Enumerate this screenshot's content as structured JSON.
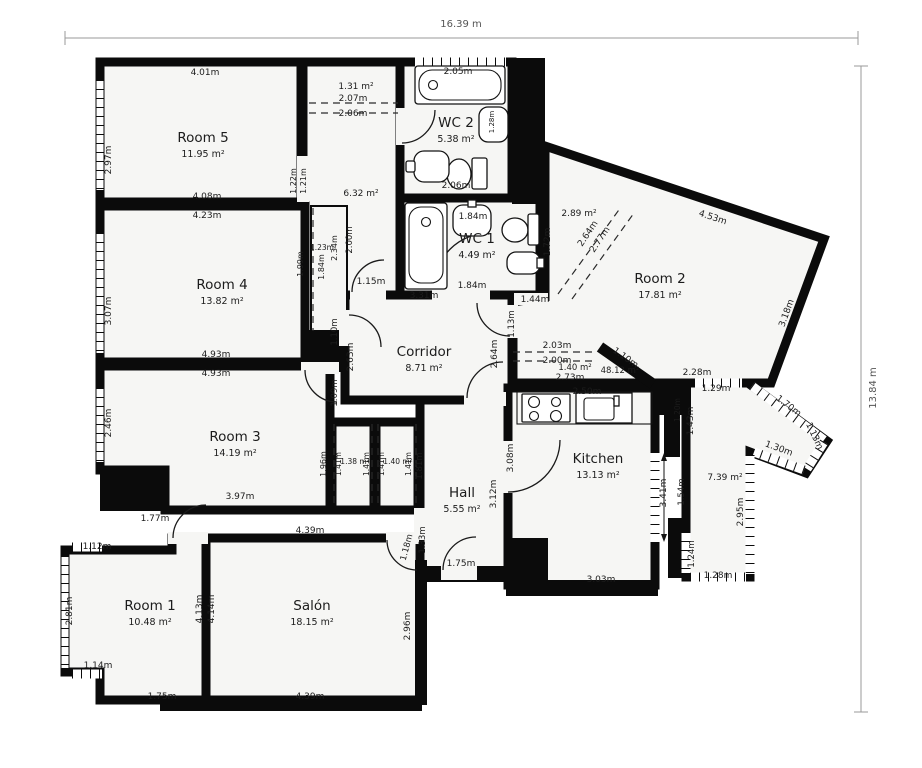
{
  "meta": {
    "plan_width_label": "16.39 m",
    "plan_height_label": "13.84 m"
  },
  "rooms": [
    {
      "id": "room5",
      "name": "Room 5",
      "area": "11.95 m²",
      "x": 203,
      "y": 142
    },
    {
      "id": "room4",
      "name": "Room 4",
      "area": "13.82 m²",
      "x": 222,
      "y": 289
    },
    {
      "id": "room3",
      "name": "Room 3",
      "area": "14.19 m²",
      "x": 235,
      "y": 441
    },
    {
      "id": "room2",
      "name": "Room 2",
      "area": "17.81 m²",
      "x": 660,
      "y": 283
    },
    {
      "id": "room1",
      "name": "Room 1",
      "area": "10.48 m²",
      "x": 150,
      "y": 610
    },
    {
      "id": "salon",
      "name": "Salón",
      "area": "18.15 m²",
      "x": 312,
      "y": 610
    },
    {
      "id": "kitchen",
      "name": "Kitchen",
      "area": "13.13 m²",
      "x": 598,
      "y": 463
    },
    {
      "id": "hall",
      "name": "Hall",
      "area": "5.55 m²",
      "x": 462,
      "y": 497
    },
    {
      "id": "corridor",
      "name": "Corridor",
      "area": "8.71 m²",
      "x": 424,
      "y": 356
    },
    {
      "id": "wc1",
      "name": "WC 1",
      "area": "4.49 m²",
      "x": 477,
      "y": 243
    },
    {
      "id": "wc2",
      "name": "WC 2",
      "area": "5.38 m²",
      "x": 456,
      "y": 127
    }
  ],
  "dims": [
    {
      "t": "4.01m",
      "x": 205,
      "y": 75
    },
    {
      "t": "2.97m",
      "x": 111,
      "y": 160,
      "r": -90
    },
    {
      "t": "4.08m",
      "x": 207,
      "y": 199
    },
    {
      "t": "4.23m",
      "x": 207,
      "y": 218
    },
    {
      "t": "1.31 m²",
      "x": 356,
      "y": 89
    },
    {
      "t": "2.07m",
      "x": 353,
      "y": 101
    },
    {
      "t": "2.06m",
      "x": 353,
      "y": 116
    },
    {
      "t": "2.05m",
      "x": 458,
      "y": 74
    },
    {
      "t": "2.06m",
      "x": 456,
      "y": 188
    },
    {
      "t": "1.28m",
      "x": 494,
      "y": 122,
      "r": -90,
      "s": 7
    },
    {
      "t": "1.22m",
      "x": 296,
      "y": 181,
      "r": -90,
      "s": 8
    },
    {
      "t": "1.21m",
      "x": 306,
      "y": 181,
      "r": -90,
      "s": 8
    },
    {
      "t": "6.32 m²",
      "x": 361,
      "y": 196
    },
    {
      "t": "1.99m",
      "x": 303,
      "y": 264,
      "r": -90,
      "s": 8
    },
    {
      "t": "1.23m",
      "x": 322,
      "y": 250,
      "s": 7.5
    },
    {
      "t": "1.84m",
      "x": 324,
      "y": 267,
      "r": -90,
      "s": 8
    },
    {
      "t": "2.34m",
      "x": 337,
      "y": 248,
      "r": -90,
      "s": 8
    },
    {
      "t": "2.00m",
      "x": 352,
      "y": 240,
      "r": -90,
      "s": 8.5
    },
    {
      "t": "1.15m",
      "x": 371,
      "y": 284
    },
    {
      "t": "1.84m",
      "x": 473,
      "y": 219
    },
    {
      "t": "1.84m",
      "x": 472,
      "y": 288
    },
    {
      "t": "1.72m",
      "x": 550,
      "y": 242,
      "r": -90
    },
    {
      "t": "3.07m",
      "x": 111,
      "y": 311,
      "r": -90
    },
    {
      "t": "4.93m",
      "x": 216,
      "y": 357
    },
    {
      "t": "4.93m",
      "x": 216,
      "y": 376
    },
    {
      "t": "3.31m",
      "x": 424,
      "y": 298
    },
    {
      "t": "2.63m",
      "x": 353,
      "y": 357,
      "r": -90
    },
    {
      "t": "2.64m",
      "x": 497,
      "y": 354,
      "r": -90
    },
    {
      "t": "1.10m",
      "x": 337,
      "y": 332,
      "r": -90,
      "s": 8.5
    },
    {
      "t": "1.09m",
      "x": 337,
      "y": 393,
      "r": -90,
      "s": 8.5
    },
    {
      "t": "1.13m",
      "x": 514,
      "y": 324,
      "r": -90,
      "s": 8.5
    },
    {
      "t": "1.44m",
      "x": 535,
      "y": 302
    },
    {
      "t": "4.53m",
      "x": 712,
      "y": 220,
      "r": 18
    },
    {
      "t": "3.18m",
      "x": 789,
      "y": 314,
      "r": -70
    },
    {
      "t": "2.89 m²",
      "x": 579,
      "y": 216
    },
    {
      "t": "2.64m",
      "x": 590,
      "y": 235,
      "r": -56
    },
    {
      "t": "2.77m",
      "x": 602,
      "y": 241,
      "r": -56
    },
    {
      "t": "2.03m",
      "x": 557,
      "y": 348
    },
    {
      "t": "2.00m",
      "x": 557,
      "y": 363
    },
    {
      "t": "1.40 m²",
      "x": 575,
      "y": 370,
      "s": 8.5
    },
    {
      "t": "2.73m",
      "x": 570,
      "y": 380
    },
    {
      "t": "48.12 m²",
      "x": 620,
      "y": 373,
      "s": 8.5
    },
    {
      "t": "1.10m",
      "x": 624,
      "y": 360,
      "r": 35
    },
    {
      "t": "2.28m",
      "x": 697,
      "y": 375
    },
    {
      "t": "1.29m",
      "x": 716,
      "y": 391
    },
    {
      "t": "1.70m",
      "x": 787,
      "y": 408,
      "r": 37
    },
    {
      "t": "1.13m",
      "x": 812,
      "y": 437,
      "r": 65
    },
    {
      "t": "1.30m",
      "x": 778,
      "y": 451,
      "r": 20
    },
    {
      "t": "1.43m",
      "x": 693,
      "y": 421,
      "r": -90
    },
    {
      "t": "1.20m",
      "x": 680,
      "y": 410,
      "r": -90,
      "s": 7.5
    },
    {
      "t": "3.41m",
      "x": 666,
      "y": 493,
      "r": -90
    },
    {
      "t": "1.54m",
      "x": 684,
      "y": 492,
      "r": -90,
      "s": 8.5
    },
    {
      "t": "2.95m",
      "x": 743,
      "y": 512,
      "r": -90
    },
    {
      "t": "1.24m",
      "x": 694,
      "y": 554,
      "r": -90,
      "s": 8.5
    },
    {
      "t": "1.28m",
      "x": 718,
      "y": 578
    },
    {
      "t": "7.39 m²",
      "x": 725,
      "y": 480
    },
    {
      "t": "2.50m",
      "x": 587,
      "y": 394
    },
    {
      "t": "3.08m",
      "x": 513,
      "y": 458,
      "r": -90
    },
    {
      "t": "3.12m",
      "x": 496,
      "y": 494,
      "r": -90
    },
    {
      "t": "3.03m",
      "x": 601,
      "y": 582
    },
    {
      "t": "2.46m",
      "x": 111,
      "y": 423,
      "r": -90
    },
    {
      "t": "3.97m",
      "x": 240,
      "y": 499
    },
    {
      "t": "1.96m",
      "x": 326,
      "y": 464,
      "r": -90,
      "s": 8
    },
    {
      "t": "1.41m",
      "x": 341,
      "y": 464,
      "r": -90,
      "s": 7.5
    },
    {
      "t": "1.38 m²",
      "x": 355,
      "y": 464,
      "s": 7.5
    },
    {
      "t": "1.41m",
      "x": 369,
      "y": 464,
      "r": -90,
      "s": 7.5
    },
    {
      "t": "1.41m",
      "x": 384,
      "y": 464,
      "r": -90,
      "s": 7.5
    },
    {
      "t": "1.40 m²",
      "x": 398,
      "y": 464,
      "s": 7.5
    },
    {
      "t": "1.41m",
      "x": 411,
      "y": 464,
      "r": -90,
      "s": 7.5
    },
    {
      "t": "1.81m",
      "x": 422,
      "y": 466,
      "r": -90,
      "s": 8.5
    },
    {
      "t": "1.75m",
      "x": 461,
      "y": 566
    },
    {
      "t": "1.33m",
      "x": 425,
      "y": 540,
      "r": -90,
      "s": 8.5
    },
    {
      "t": "1.18m",
      "x": 409,
      "y": 548,
      "r": -75,
      "s": 8.5
    },
    {
      "t": "1.77m",
      "x": 155,
      "y": 521
    },
    {
      "t": "1.12m",
      "x": 97,
      "y": 549
    },
    {
      "t": "2.81m",
      "x": 72,
      "y": 611,
      "r": -90
    },
    {
      "t": "1.14m",
      "x": 98,
      "y": 668
    },
    {
      "t": "1.75m",
      "x": 162,
      "y": 699
    },
    {
      "t": "4.13m",
      "x": 202,
      "y": 609,
      "r": -90
    },
    {
      "t": "4.14m",
      "x": 214,
      "y": 609,
      "r": -90
    },
    {
      "t": "4.39m",
      "x": 310,
      "y": 533
    },
    {
      "t": "4.39m",
      "x": 310,
      "y": 699
    },
    {
      "t": "2.96m",
      "x": 410,
      "y": 626,
      "r": -90
    }
  ]
}
